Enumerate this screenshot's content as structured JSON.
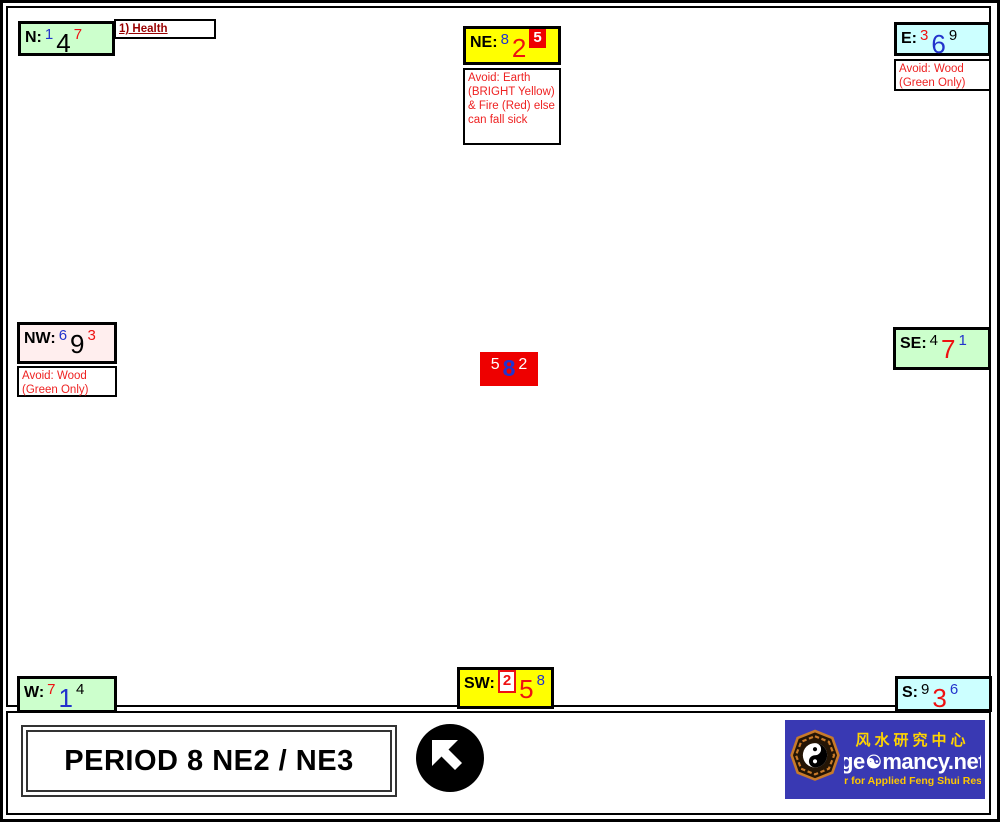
{
  "colors": {
    "sector_green": "#ccffcc",
    "sector_yellow": "#ffff00",
    "sector_cyan": "#ccffff",
    "sector_pink": "#ffeeee",
    "center_red": "#ee0000",
    "digit_blue": "#2233cc",
    "digit_red": "#ee1111",
    "avoid_text_red": "#ee2222",
    "health_text_maroon": "#990000",
    "logo_blue": "#3939b3",
    "logo_yellow": "#ffd400"
  },
  "sectors": [
    {
      "key": "N",
      "label": "N:",
      "digits": [
        {
          "t": "1",
          "color": "blue"
        },
        {
          "t": "4",
          "color": "black"
        },
        {
          "t": "7",
          "color": "red"
        }
      ]
    },
    {
      "key": "NE",
      "label": "NE:",
      "digits": [
        {
          "t": "8",
          "color": "blue"
        },
        {
          "t": "2",
          "color": "red"
        },
        {
          "t": "5",
          "color": "white-on-red"
        }
      ]
    },
    {
      "key": "E",
      "label": "E:",
      "digits": [
        {
          "t": "3",
          "color": "red"
        },
        {
          "t": "6",
          "color": "blue"
        },
        {
          "t": "9",
          "color": "black"
        }
      ]
    },
    {
      "key": "NW",
      "label": "NW:",
      "digits": [
        {
          "t": "6",
          "color": "blue"
        },
        {
          "t": "9",
          "color": "black"
        },
        {
          "t": "3",
          "color": "red"
        }
      ]
    },
    {
      "key": "CENTER",
      "label": "",
      "digits": [
        {
          "t": "5",
          "color": "white"
        },
        {
          "t": "8",
          "color": "blue"
        },
        {
          "t": "2",
          "color": "white"
        }
      ]
    },
    {
      "key": "SE",
      "label": "SE:",
      "digits": [
        {
          "t": "4",
          "color": "black"
        },
        {
          "t": "7",
          "color": "red"
        },
        {
          "t": "1",
          "color": "blue"
        }
      ]
    },
    {
      "key": "W",
      "label": "W:",
      "digits": [
        {
          "t": "7",
          "color": "red"
        },
        {
          "t": "1",
          "color": "blue"
        },
        {
          "t": "4",
          "color": "black"
        }
      ]
    },
    {
      "key": "SW",
      "label": "SW:",
      "digits": [
        {
          "t": "2",
          "color": "red-on-white"
        },
        {
          "t": "5",
          "color": "red"
        },
        {
          "t": "8",
          "color": "blue"
        }
      ]
    },
    {
      "key": "S",
      "label": "S:",
      "digits": [
        {
          "t": "9",
          "color": "black"
        },
        {
          "t": "3",
          "color": "red"
        },
        {
          "t": "6",
          "color": "blue"
        }
      ]
    }
  ],
  "annotations": {
    "health_label": "1) Health",
    "ne_avoid": "Avoid: Earth (BRIGHT Yellow) & Fire (Red) else can fall sick",
    "e_avoid": "Avoid: Wood (Green Only)",
    "nw_avoid": "Avoid: Wood (Green Only)"
  },
  "footer": {
    "title": "PERIOD 8 NE2 / NE3",
    "facing_arrow_icon": "arrow-up-left-icon"
  },
  "logo": {
    "bagua_icon": "bagua-icon",
    "chinese": "风水研究中心",
    "brand_pre": "ge",
    "yinyang_icon": "☯",
    "brand_post": "mancy.net",
    "tagline": "Center for Applied Feng Shui Research"
  }
}
